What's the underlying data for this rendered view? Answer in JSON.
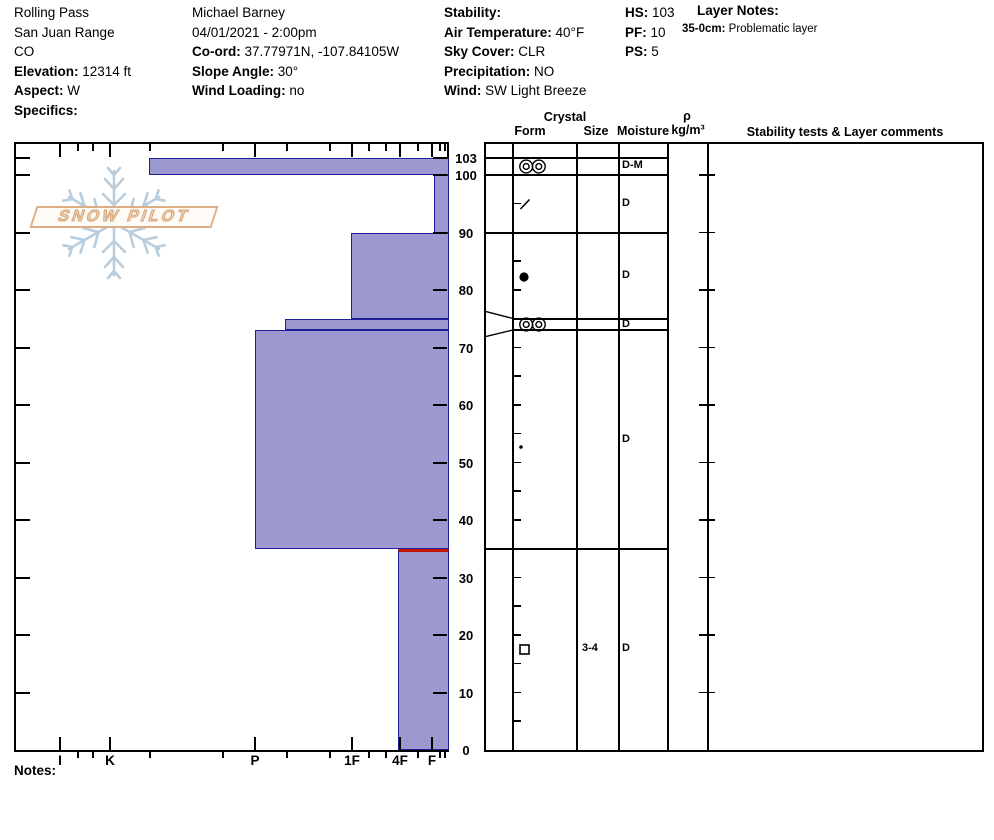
{
  "app": {
    "notes_label": "Notes:"
  },
  "logo": {
    "text": "SNOW PILOT"
  },
  "header_columns": [
    {
      "id": "location",
      "lines": [
        {
          "label": "",
          "value": "Rolling Pass"
        },
        {
          "label": "",
          "value": "San Juan Range"
        },
        {
          "label": "",
          "value": "CO"
        },
        {
          "label": "Elevation:",
          "value": "12314 ft"
        },
        {
          "label": "Aspect:",
          "value": "W"
        },
        {
          "label": "Specifics:",
          "value": ""
        }
      ]
    },
    {
      "id": "observer",
      "lines": [
        {
          "label": "",
          "value": "Michael Barney"
        },
        {
          "label": "",
          "value": "04/01/2021 - 2:00pm"
        },
        {
          "label": "Co-ord:",
          "value": "37.77971N, -107.84105W"
        },
        {
          "label": "Slope Angle:",
          "value": "30°"
        },
        {
          "label": "Wind Loading:",
          "value": "no"
        }
      ]
    },
    {
      "id": "conditions",
      "lines": [
        {
          "label": "Stability:",
          "value": ""
        },
        {
          "label": "Air Temperature:",
          "value": "40°F"
        },
        {
          "label": "Sky Cover:",
          "value": "CLR"
        },
        {
          "label": "Precipitation:",
          "value": "NO"
        },
        {
          "label": "Wind:",
          "value": "SW Light Breeze"
        }
      ]
    },
    {
      "id": "snowpack",
      "lines": [
        {
          "label": "HS:",
          "value": "103"
        },
        {
          "label": "PF:",
          "value": "10"
        },
        {
          "label": "PS:",
          "value": "5"
        }
      ]
    }
  ],
  "layer_notes": {
    "title": "Layer Notes:",
    "entries": [
      {
        "label": "35-0cm:",
        "text": "Problematic layer"
      }
    ]
  },
  "chart_data": {
    "type": "bar",
    "title": "Snow hardness profile (hand hardness vs depth)",
    "orientation": "horizontal layer bars, hard (left) to soft (right)",
    "xlabel": "hand hardness",
    "ylabel": "depth (cm)",
    "hardness_tick_labels": [
      "I",
      "K",
      "P",
      "1F",
      "4F",
      "F"
    ],
    "depth_tick_labels": [
      103,
      100,
      90,
      80,
      70,
      60,
      50,
      40,
      30,
      20,
      10,
      0
    ],
    "ylim": [
      0,
      105.7
    ],
    "total_depth_cm": 103,
    "layers": [
      {
        "top_cm": 103,
        "bottom_cm": 100,
        "hardness": "K-",
        "form": "melt-freeze-crust",
        "moisture": "D-M",
        "size_mm": ""
      },
      {
        "top_cm": 100,
        "bottom_cm": 90,
        "hardness": "F",
        "form": "decomposing-fragments",
        "moisture": "D",
        "size_mm": ""
      },
      {
        "top_cm": 90,
        "bottom_cm": 75,
        "hardness": "1F",
        "form": "rounded-grains",
        "moisture": "D",
        "size_mm": ""
      },
      {
        "top_cm": 75,
        "bottom_cm": 73,
        "hardness": "P-",
        "form": "melt-freeze-crust",
        "moisture": "D",
        "size_mm": "",
        "layer_of_concern": true
      },
      {
        "top_cm": 73,
        "bottom_cm": 35,
        "hardness": "P",
        "form": "rounded-grains-small",
        "moisture": "D",
        "size_mm": ""
      },
      {
        "top_cm": 35,
        "bottom_cm": 0,
        "hardness": "4F",
        "form": "faceted-crystals",
        "moisture": "D",
        "size_mm": "3-4",
        "highlight_top_red": true
      }
    ]
  },
  "layer_table": {
    "headers": {
      "crystal_group": "Crystal",
      "form": "Form",
      "size": "Size",
      "moisture": "Moisture",
      "density_symbol": "ρ",
      "density_unit": "kg/m³",
      "comments": "Stability tests & Layer comments"
    }
  },
  "colors": {
    "bar_fill": "#9b99d0",
    "bar_border": "#1f1f99",
    "concern_red": "#c11400",
    "logo_tan": "#ddae86",
    "snowflake": "#b9cddd"
  }
}
